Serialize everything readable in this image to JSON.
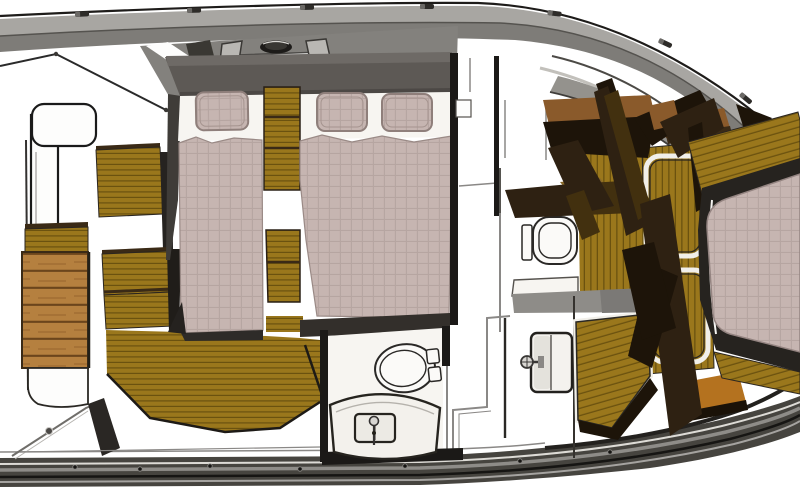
{
  "document": {
    "kind": "3d-floorplan-rendering",
    "subject": "Yacht lower-deck interior floor plan, top-down 3D rendering",
    "visible_text": "none"
  },
  "colors": {
    "canvas": "#ffffff",
    "hullLine": "#1e1c1a",
    "deckLight": "#a8a6a2",
    "deckBand": "#7e7c78",
    "deckMid": "#83817d",
    "deckDark": "#73716d",
    "bulwark": "#46443f",
    "headboard": "#5d5955",
    "headboardTop": "#6e6a66",
    "wall": "#1b1917",
    "wallSoft": "#8a8886",
    "white": "#f7f5f1",
    "mattress": "#c6b5b1",
    "mattressLine": "#b2a19d",
    "pillowEdge": "#8f7f7b",
    "teak": "#9a771c",
    "teakStripe": "#6b520f",
    "slatWood": "#b5803f",
    "slatLine": "#6b451c",
    "counterWood": "#8a5a2b",
    "counterEdge": "#3a2a16",
    "stair": "#2e2112",
    "stairDark": "#1d1409",
    "stairFacet": "#42300f",
    "orangeStep": "#b4721f",
    "fixture": "#2a2826",
    "grayFloor": "#8e8c88"
  },
  "components": {
    "hull": [
      "port-deck-band",
      "starboard-rub-rail",
      "bow-railing",
      "stern-hull-curves",
      "cleats",
      "stanchion"
    ],
    "foredeck": [
      "bow-seat",
      "bow-locker-panel",
      "deck-hatch-oval",
      "hatch-frame"
    ],
    "forward_cabin": {
      "berth_count": 2,
      "pillow_count": 3,
      "furniture": [
        "headboard",
        "center-step-cabinet",
        "port-bench-steps",
        "teak-cabin-floor",
        "slatted-steps"
      ]
    },
    "forward_head": {
      "fixtures": [
        "toilet",
        "vanity-counter",
        "sink-basin",
        "faucet"
      ]
    },
    "mid_head": {
      "fixtures": [
        "toilet",
        "sink-basin",
        "faucet",
        "shower-floor",
        "locker-doors"
      ]
    },
    "companionway": [
      "wood-counter",
      "stair-stringers",
      "teak-floor-strips",
      "floor-hatches",
      "diagonal-teak-landing",
      "orange-step"
    ],
    "aft_cabin": {
      "berth_count": 1,
      "furniture": [
        "mattress",
        "bed-frame",
        "teak-floor-border"
      ]
    }
  }
}
